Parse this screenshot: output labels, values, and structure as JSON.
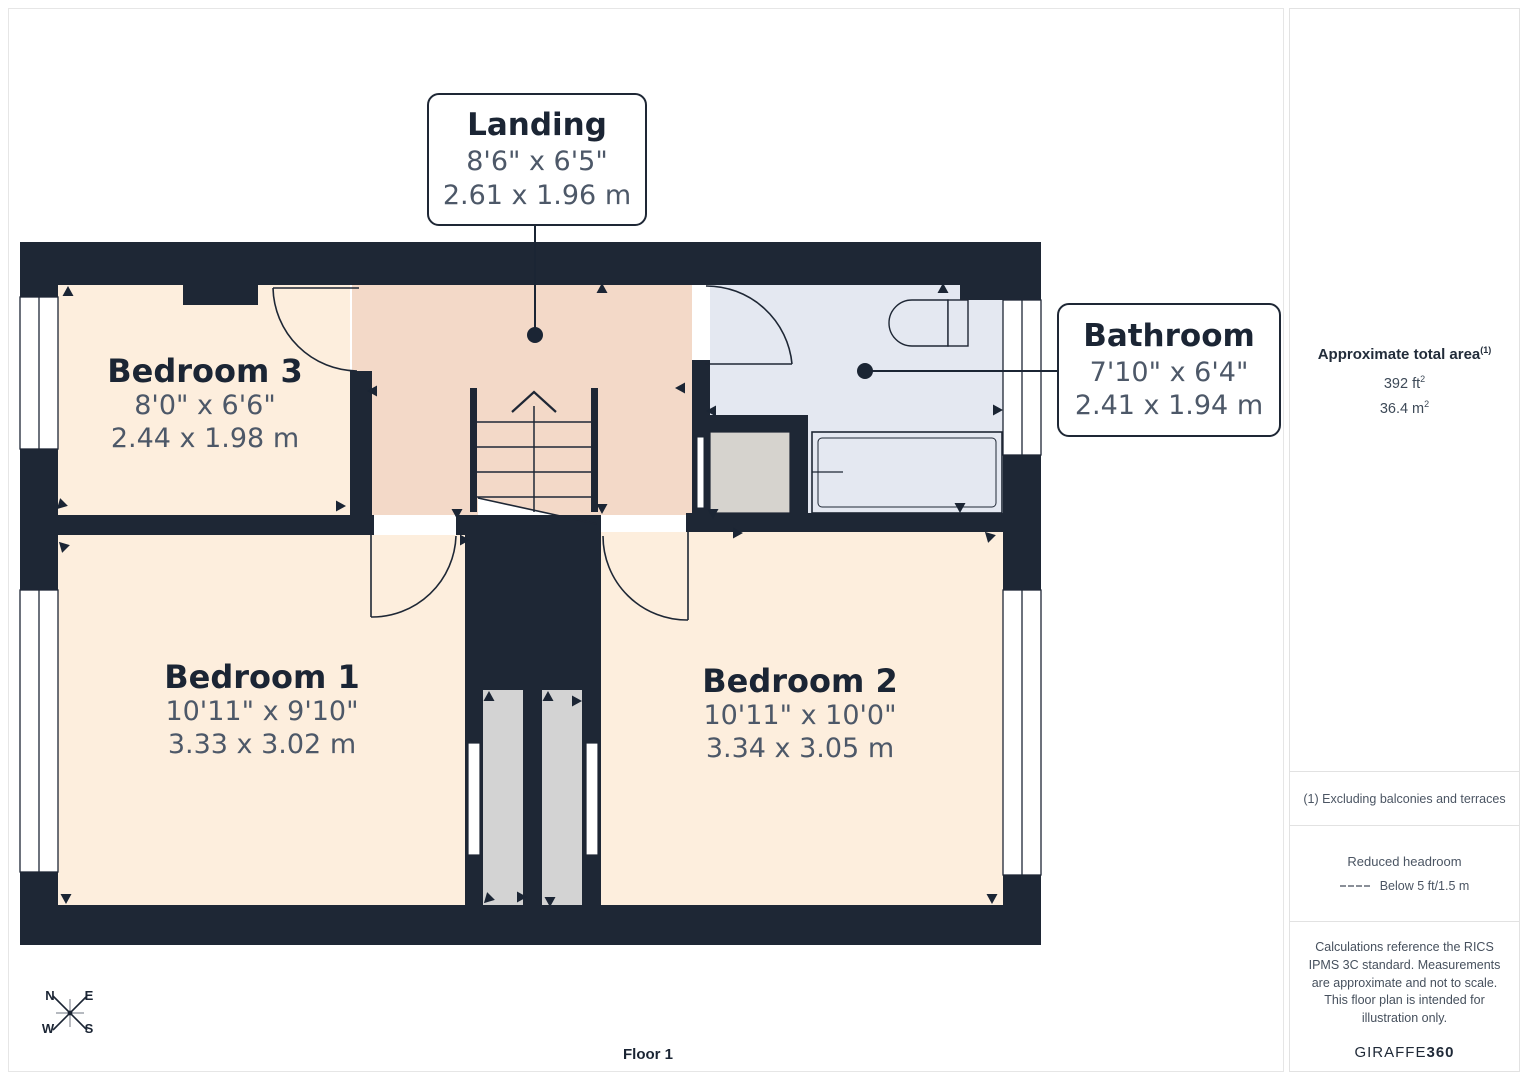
{
  "colors": {
    "wall": "#1e2735",
    "bedroom_floor": "#fdeedd",
    "landing_floor": "#f3d9c8",
    "bathroom_floor": "#e4e8f1",
    "cupboard_floor": "#d6d3ce",
    "reduced_area": "#d3d3d3",
    "label_text": "#1b2534",
    "dimension_text": "#4d5868"
  },
  "plan": {
    "floor_label": "Floor 1",
    "rooms": [
      {
        "name": "Bedroom 3",
        "imperial": "8'0\" x 6'6\"",
        "metric": "2.44 x 1.98 m"
      },
      {
        "name": "Bedroom 1",
        "imperial": "10'11\" x 9'10\"",
        "metric": "3.33 x 3.02 m"
      },
      {
        "name": "Bedroom 2",
        "imperial": "10'11\" x 10'0\"",
        "metric": "3.34 x 3.05 m"
      }
    ],
    "callouts": [
      {
        "name": "Landing",
        "imperial": "8'6\" x 6'5\"",
        "metric": "2.61 x 1.96 m"
      },
      {
        "name": "Bathroom",
        "imperial": "7'10\" x 6'4\"",
        "metric": "2.41 x 1.94 m"
      }
    ],
    "compass": {
      "n": "N",
      "e": "E",
      "s": "S",
      "w": "W"
    }
  },
  "sidebar": {
    "area_title": "Approximate total area",
    "area_footnote_marker": "(1)",
    "area_imperial": "392 ft",
    "area_imperial_sup": "2",
    "area_metric": "36.4 m",
    "area_metric_sup": "2",
    "footnote": "(1) Excluding balconies and terraces",
    "headroom_title": "Reduced headroom",
    "headroom_legend": "Below 5 ft/1.5 m",
    "disclaimer": "Calculations reference the RICS IPMS 3C standard. Measurements are approximate and not to scale. This floor plan is intended for illustration only.",
    "brand_name": "GIRAFFE",
    "brand_suffix": "360"
  }
}
